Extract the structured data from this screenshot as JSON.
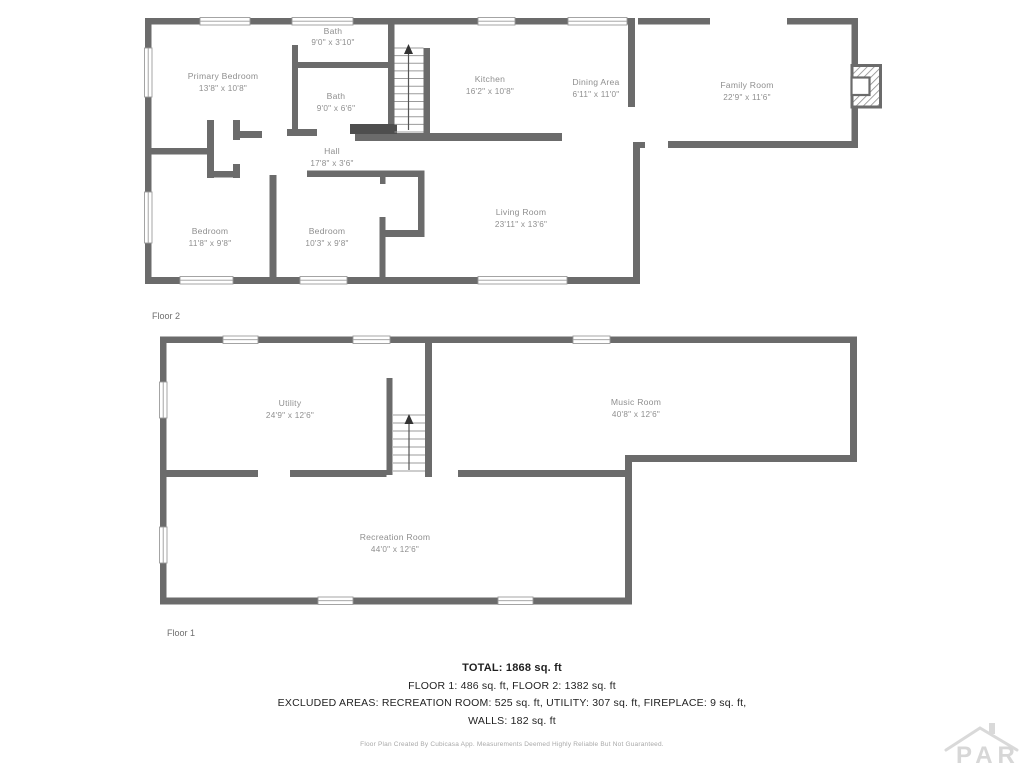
{
  "page": {
    "background": "#ffffff"
  },
  "colors": {
    "wall": "#6b6b6b",
    "wall_dark": "#4e4e4e",
    "window_stroke": "#9b9b9b",
    "room_label": "#8f8f8f",
    "floor_label": "#6e6e6e",
    "summary_text": "#1f1f1f",
    "disclaimer_text": "#a8a8a8",
    "watermark": "#d7d7d7"
  },
  "floor2": {
    "label": "Floor 2",
    "rooms": [
      {
        "name": "Primary Bedroom",
        "dims": "13'8\" x 10'8\""
      },
      {
        "name": "Bath",
        "dims": "9'0\" x 3'10\""
      },
      {
        "name": "Bath",
        "dims": "9'0\" x 6'6\""
      },
      {
        "name": "Kitchen",
        "dims": "16'2\" x 10'8\""
      },
      {
        "name": "Dining Area",
        "dims": "6'11\" x 11'0\""
      },
      {
        "name": "Family Room",
        "dims": "22'9\" x 11'6\""
      },
      {
        "name": "Hall",
        "dims": "17'8\" x 3'6\""
      },
      {
        "name": "Bedroom",
        "dims": "11'8\" x 9'8\""
      },
      {
        "name": "Bedroom",
        "dims": "10'3\" x 9'8\""
      },
      {
        "name": "Living Room",
        "dims": "23'11\" x 13'6\""
      }
    ]
  },
  "floor1": {
    "label": "Floor 1",
    "rooms": [
      {
        "name": "Utility",
        "dims": "24'9\" x 12'6\""
      },
      {
        "name": "Music Room",
        "dims": "40'8\" x 12'6\""
      },
      {
        "name": "Recreation Room",
        "dims": "44'0\" x 12'6\""
      }
    ]
  },
  "summary": {
    "total": "TOTAL: 1868 sq. ft",
    "floors": "FLOOR 1: 486 sq. ft, FLOOR 2: 1382 sq. ft",
    "excluded": "EXCLUDED AREAS: RECREATION ROOM: 525 sq. ft, UTILITY: 307 sq. ft, FIREPLACE: 9 sq. ft,",
    "walls": "WALLS: 182 sq. ft",
    "disclaimer": "Floor Plan Created By Cubicasa App. Measurements Deemed Highly Reliable But Not Guaranteed."
  },
  "watermark": {
    "text": "PAR"
  }
}
